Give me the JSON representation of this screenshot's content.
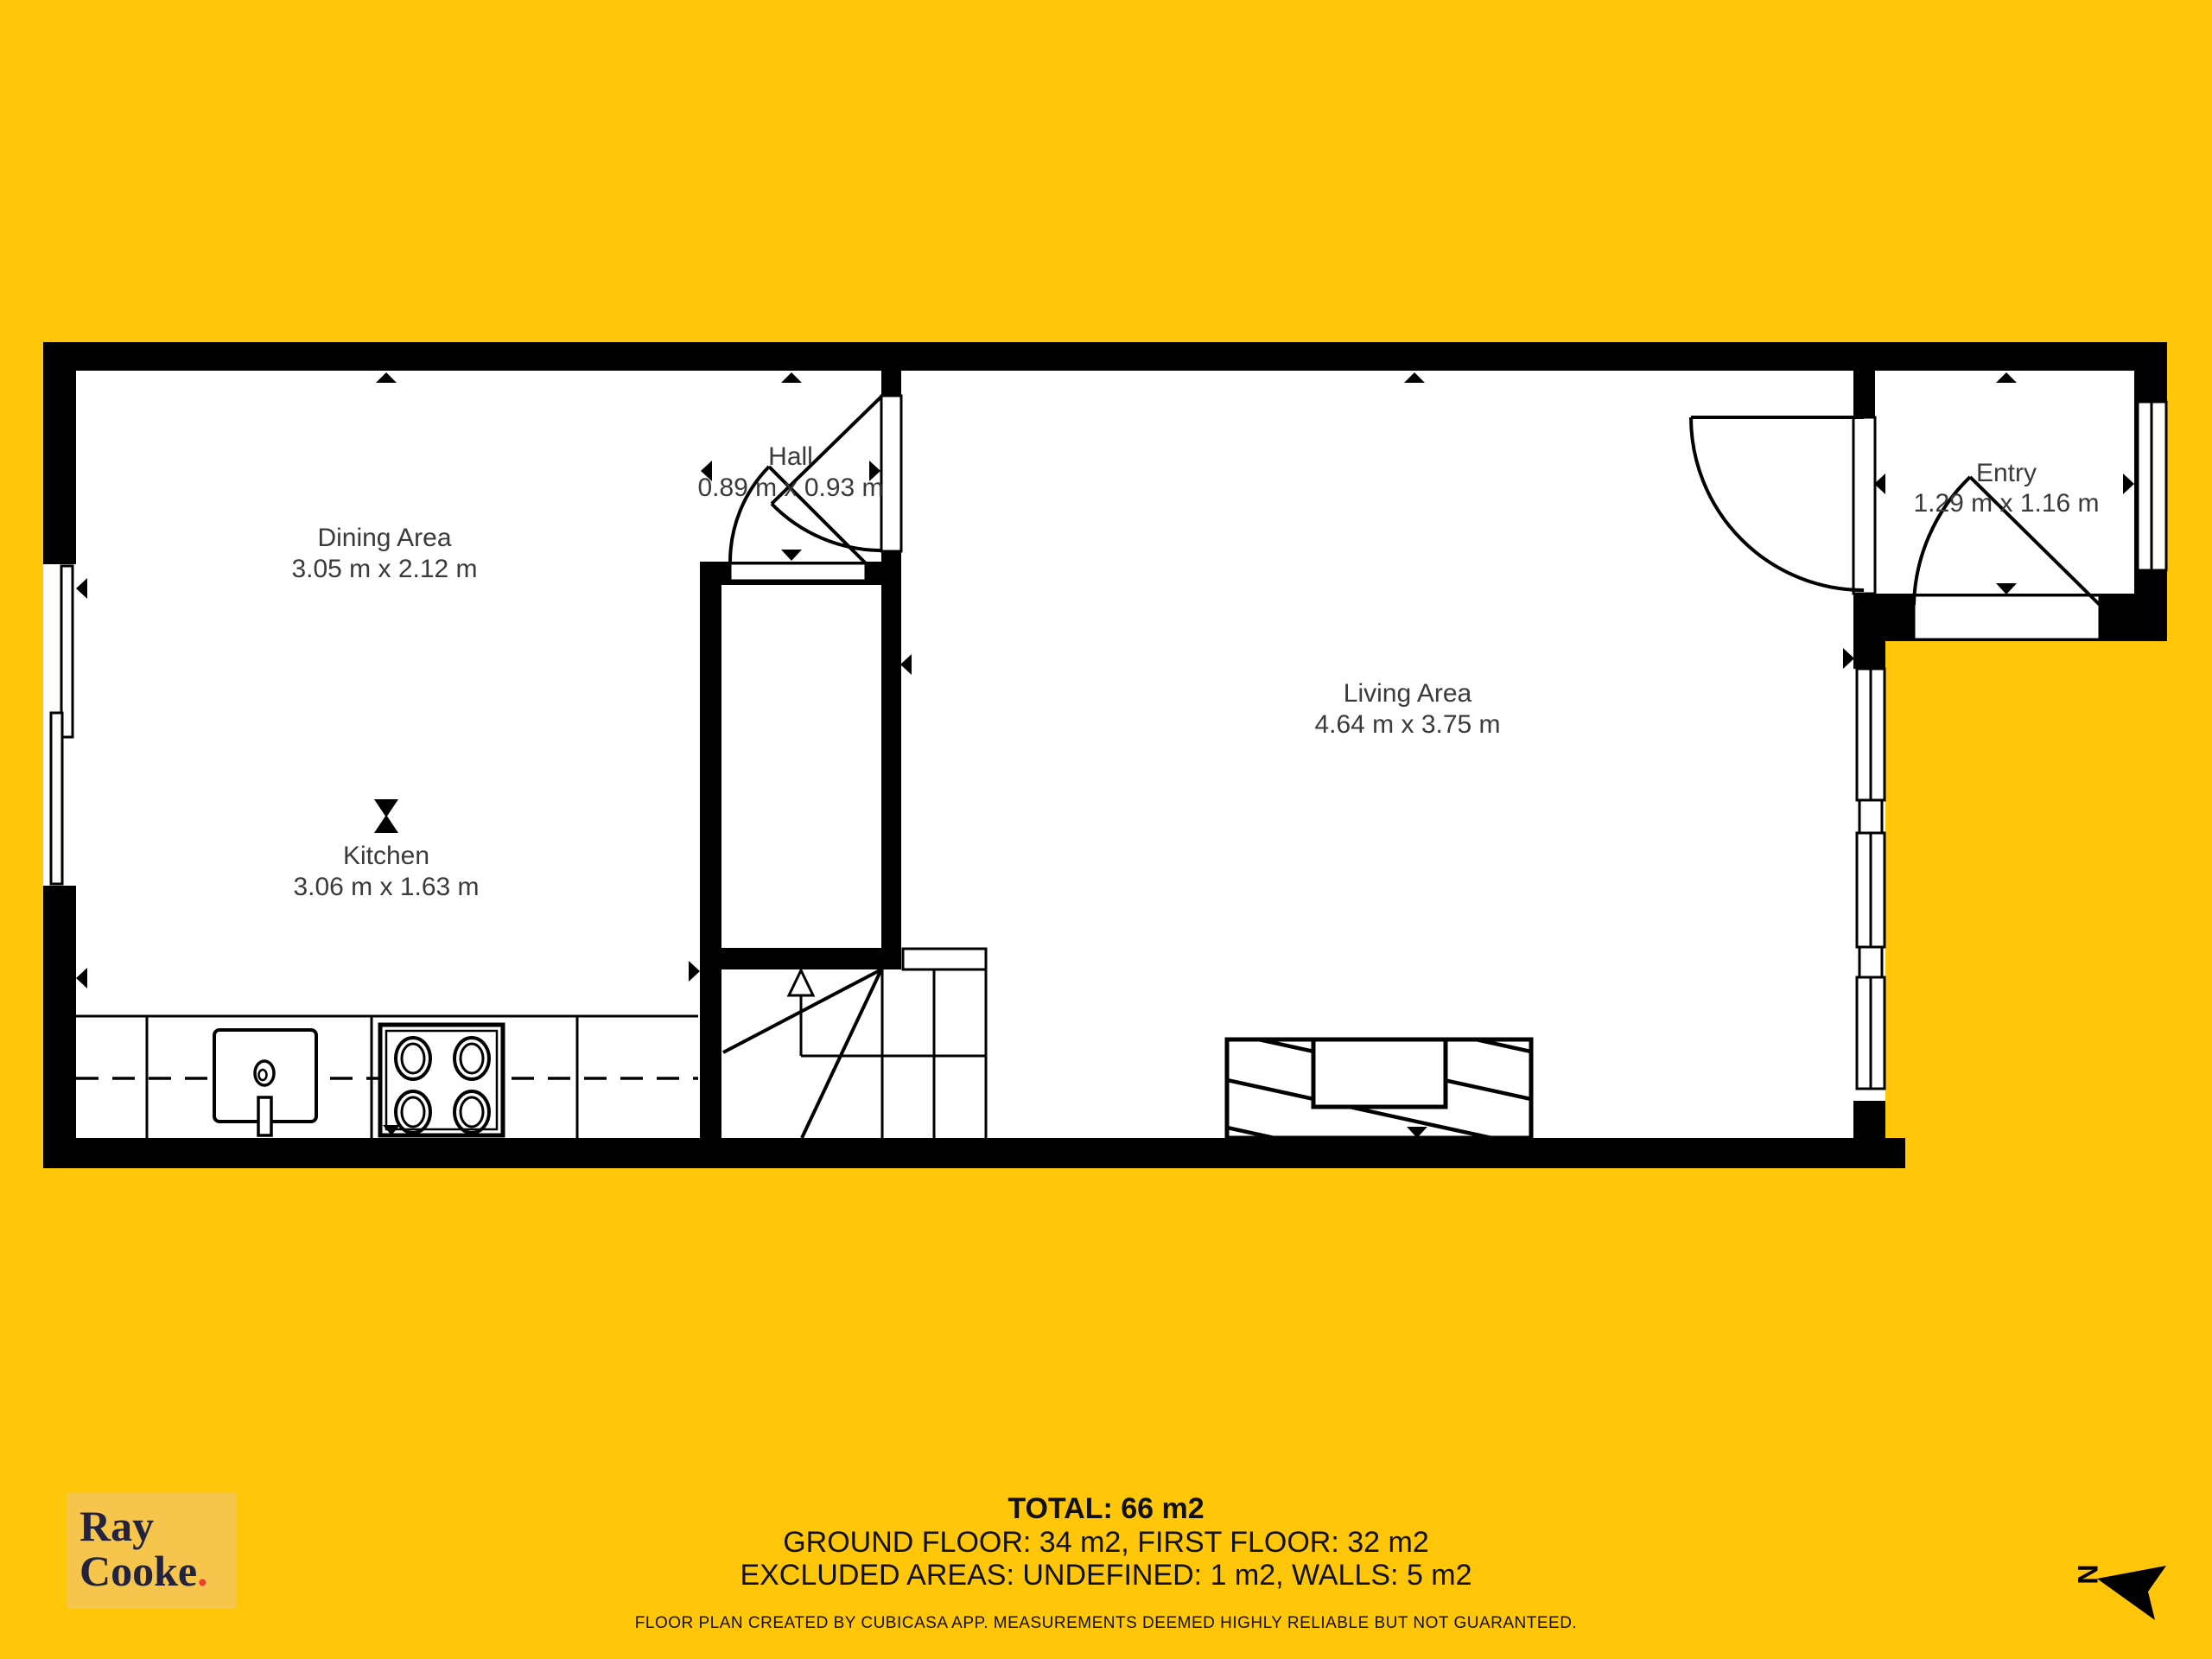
{
  "colors": {
    "page_yellow": "#ffc60a",
    "logo_yellow": "#f5c64b",
    "brand_navy": "#23233f",
    "brand_red": "#e8432e",
    "wall_black": "#000000",
    "floor_white": "#ffffff",
    "label_gray": "#3a3a3a"
  },
  "rooms": [
    {
      "name": "Dining Area",
      "dims": "3.05 m x 2.12 m"
    },
    {
      "name": "Kitchen",
      "dims": "3.06 m x 1.63 m"
    },
    {
      "name": "Hall",
      "dims": "0.89 m x 0.93 m"
    },
    {
      "name": "Living Area",
      "dims": "4.64 m x 3.75 m"
    },
    {
      "name": "Entry",
      "dims": "1.29 m x 1.16 m"
    }
  ],
  "summary": {
    "total": "TOTAL: 66 m2",
    "floors": "GROUND FLOOR: 34 m2, FIRST FLOOR: 32 m2",
    "excluded": "EXCLUDED AREAS: UNDEFINED: 1 m2, WALLS: 5 m2",
    "disclaimer": "FLOOR PLAN CREATED BY CUBICASA APP. MEASUREMENTS DEEMED HIGHLY RELIABLE BUT NOT GUARANTEED."
  },
  "logo": {
    "line1": "Ray",
    "line2": "Cooke",
    "dot": "."
  },
  "compass": {
    "label": "N"
  }
}
